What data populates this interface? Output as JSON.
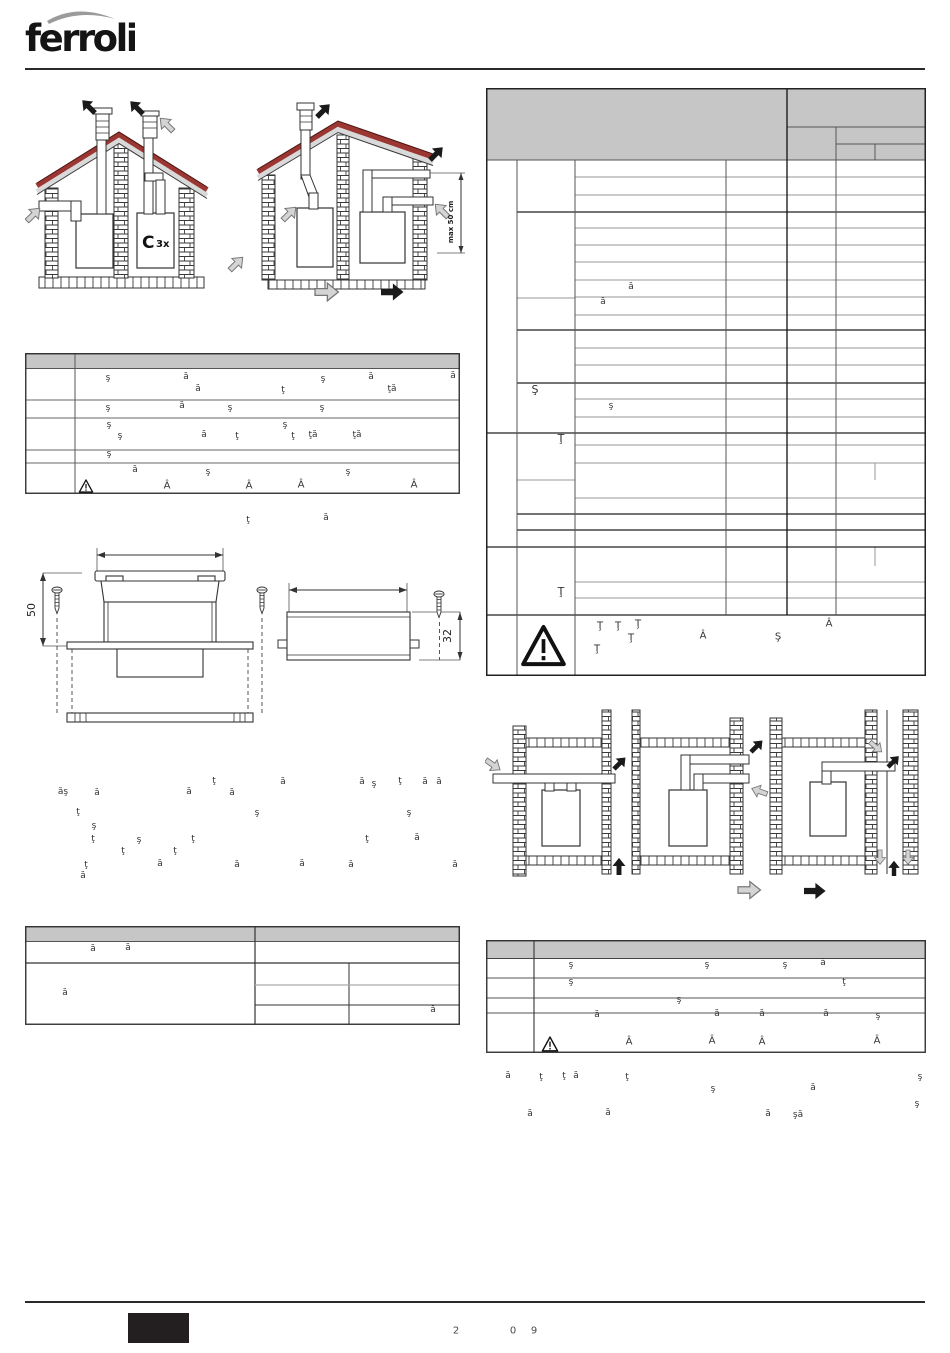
{
  "brand": {
    "logo_text": "ferroli"
  },
  "labels": {
    "flue_type_main": "C",
    "flue_type_sub": "3x",
    "max_distance": "max 50 cm",
    "dim_height": "50",
    "dim_depth": "32"
  },
  "colors": {
    "table_header_gray": "#c6c6c6",
    "roof_red": "#9c3632",
    "arrow_black": "#1a1a1a",
    "arrow_gray": "#d4d4d4"
  },
  "scatter": {
    "big_table": [
      {
        "t": "ă",
        "x": 631,
        "y": 288
      },
      {
        "t": "ă",
        "x": 603,
        "y": 303
      },
      {
        "t": "Ş",
        "x": 535,
        "y": 390,
        "s": 11
      },
      {
        "t": "ş",
        "x": 611,
        "y": 407
      },
      {
        "t": "Ţ",
        "x": 561,
        "y": 439,
        "s": 11
      },
      {
        "t": "Ţ",
        "x": 561,
        "y": 592,
        "s": 11
      },
      {
        "t": "Ţ",
        "x": 600,
        "y": 627,
        "s": 10
      },
      {
        "t": "Ţ",
        "x": 618,
        "y": 627,
        "s": 10
      },
      {
        "t": "Ţ",
        "x": 638,
        "y": 625,
        "s": 10
      },
      {
        "t": "Ţ",
        "x": 631,
        "y": 639,
        "s": 10
      },
      {
        "t": "Â",
        "x": 703,
        "y": 637,
        "s": 10
      },
      {
        "t": "Ş",
        "x": 778,
        "y": 638,
        "s": 10
      },
      {
        "t": "Â",
        "x": 829,
        "y": 625,
        "s": 10
      },
      {
        "t": "Ţ",
        "x": 597,
        "y": 650,
        "s": 10
      }
    ],
    "left_table": [
      {
        "t": "ş",
        "x": 108,
        "y": 379
      },
      {
        "t": "ă",
        "x": 186,
        "y": 378
      },
      {
        "t": "ş",
        "x": 323,
        "y": 380
      },
      {
        "t": "ă",
        "x": 371,
        "y": 378
      },
      {
        "t": "ă",
        "x": 453,
        "y": 377
      },
      {
        "t": "ă",
        "x": 198,
        "y": 390
      },
      {
        "t": "ţ",
        "x": 283,
        "y": 391
      },
      {
        "t": "ţă",
        "x": 392,
        "y": 390
      },
      {
        "t": "ş",
        "x": 108,
        "y": 409
      },
      {
        "t": "ă",
        "x": 182,
        "y": 407
      },
      {
        "t": "ş",
        "x": 230,
        "y": 409
      },
      {
        "t": "ş",
        "x": 322,
        "y": 409
      },
      {
        "t": "ş",
        "x": 109,
        "y": 426
      },
      {
        "t": "ş",
        "x": 285,
        "y": 426
      },
      {
        "t": "ş",
        "x": 120,
        "y": 437
      },
      {
        "t": "ă",
        "x": 204,
        "y": 436
      },
      {
        "t": "ţ",
        "x": 237,
        "y": 437
      },
      {
        "t": "ţ",
        "x": 293,
        "y": 437
      },
      {
        "t": "ţă",
        "x": 313,
        "y": 436
      },
      {
        "t": "ţă",
        "x": 357,
        "y": 436
      },
      {
        "t": "ş",
        "x": 109,
        "y": 455
      },
      {
        "t": "ă",
        "x": 135,
        "y": 471
      },
      {
        "t": "ş",
        "x": 208,
        "y": 473
      },
      {
        "t": "ş",
        "x": 348,
        "y": 473
      },
      {
        "t": "Â",
        "x": 167,
        "y": 487,
        "s": 10
      },
      {
        "t": "Â",
        "x": 249,
        "y": 487,
        "s": 10
      },
      {
        "t": "Â",
        "x": 301,
        "y": 486,
        "s": 10
      },
      {
        "t": "Â",
        "x": 414,
        "y": 486,
        "s": 10
      }
    ],
    "mid_line": [
      {
        "t": "ţ",
        "x": 248,
        "y": 521
      },
      {
        "t": "ă",
        "x": 326,
        "y": 519
      }
    ],
    "paragraph": [
      {
        "t": "ţ",
        "x": 214,
        "y": 782
      },
      {
        "t": "ă",
        "x": 283,
        "y": 783
      },
      {
        "t": "ă",
        "x": 362,
        "y": 783
      },
      {
        "t": "ş",
        "x": 374,
        "y": 785
      },
      {
        "t": "ţ",
        "x": 400,
        "y": 782
      },
      {
        "t": "ă",
        "x": 425,
        "y": 783
      },
      {
        "t": "ă",
        "x": 439,
        "y": 783
      },
      {
        "t": "ăş",
        "x": 63,
        "y": 793
      },
      {
        "t": "ă",
        "x": 97,
        "y": 794
      },
      {
        "t": "ă",
        "x": 189,
        "y": 793
      },
      {
        "t": "ă",
        "x": 232,
        "y": 794
      },
      {
        "t": "ţ",
        "x": 78,
        "y": 813
      },
      {
        "t": "ş",
        "x": 257,
        "y": 814
      },
      {
        "t": "ş",
        "x": 409,
        "y": 814
      },
      {
        "t": "ş",
        "x": 94,
        "y": 827
      },
      {
        "t": "ţ",
        "x": 93,
        "y": 840
      },
      {
        "t": "ş",
        "x": 139,
        "y": 841
      },
      {
        "t": "ţ",
        "x": 193,
        "y": 840
      },
      {
        "t": "ţ",
        "x": 367,
        "y": 840
      },
      {
        "t": "ă",
        "x": 417,
        "y": 839
      },
      {
        "t": "ţ",
        "x": 123,
        "y": 852
      },
      {
        "t": "ţ",
        "x": 175,
        "y": 852
      },
      {
        "t": "ţ",
        "x": 86,
        "y": 866
      },
      {
        "t": "ă",
        "x": 160,
        "y": 865
      },
      {
        "t": "ă",
        "x": 237,
        "y": 866
      },
      {
        "t": "ă",
        "x": 302,
        "y": 865
      },
      {
        "t": "ă",
        "x": 351,
        "y": 866
      },
      {
        "t": "ă",
        "x": 455,
        "y": 866
      },
      {
        "t": "ă",
        "x": 83,
        "y": 877
      }
    ],
    "bottom_left_table": [
      {
        "t": "ă",
        "x": 93,
        "y": 950
      },
      {
        "t": "ă",
        "x": 128,
        "y": 949
      },
      {
        "t": "ă",
        "x": 65,
        "y": 994
      },
      {
        "t": "ă",
        "x": 433,
        "y": 1011
      }
    ],
    "bottom_right_table": [
      {
        "t": "ş",
        "x": 571,
        "y": 966
      },
      {
        "t": "ş",
        "x": 707,
        "y": 966
      },
      {
        "t": "ş",
        "x": 785,
        "y": 966
      },
      {
        "t": "ă",
        "x": 823,
        "y": 964
      },
      {
        "t": "ş",
        "x": 571,
        "y": 983
      },
      {
        "t": "ţ",
        "x": 844,
        "y": 983
      },
      {
        "t": "ş",
        "x": 679,
        "y": 1001
      },
      {
        "t": "ă",
        "x": 597,
        "y": 1016
      },
      {
        "t": "ă",
        "x": 717,
        "y": 1015
      },
      {
        "t": "ă",
        "x": 762,
        "y": 1015
      },
      {
        "t": "ă",
        "x": 826,
        "y": 1015
      },
      {
        "t": "ş",
        "x": 878,
        "y": 1017
      },
      {
        "t": "Â",
        "x": 629,
        "y": 1043,
        "s": 10
      },
      {
        "t": "Â",
        "x": 712,
        "y": 1042,
        "s": 10
      },
      {
        "t": "Â",
        "x": 762,
        "y": 1043,
        "s": 10
      },
      {
        "t": "Â",
        "x": 877,
        "y": 1042,
        "s": 10
      }
    ],
    "bottom_right_text": [
      {
        "t": "ă",
        "x": 508,
        "y": 1077
      },
      {
        "t": "ţ",
        "x": 541,
        "y": 1078
      },
      {
        "t": "ţ",
        "x": 564,
        "y": 1077
      },
      {
        "t": "ă",
        "x": 576,
        "y": 1077
      },
      {
        "t": "ţ",
        "x": 627,
        "y": 1078
      },
      {
        "t": "ş",
        "x": 920,
        "y": 1078
      },
      {
        "t": "ş",
        "x": 713,
        "y": 1090
      },
      {
        "t": "ă",
        "x": 813,
        "y": 1089
      },
      {
        "t": "ş",
        "x": 917,
        "y": 1105
      },
      {
        "t": "ă",
        "x": 530,
        "y": 1115
      },
      {
        "t": "ă",
        "x": 608,
        "y": 1114
      },
      {
        "t": "ă",
        "x": 768,
        "y": 1115
      },
      {
        "t": "şă",
        "x": 798,
        "y": 1116
      }
    ],
    "footer": [
      {
        "t": "2",
        "x": 456,
        "y": 1332,
        "s": 10,
        "c": "#4a4a4a"
      },
      {
        "t": "0",
        "x": 513,
        "y": 1332,
        "s": 10,
        "c": "#4a4a4a"
      },
      {
        "t": "9",
        "x": 534,
        "y": 1332,
        "s": 10,
        "c": "#4a4a4a"
      }
    ]
  }
}
